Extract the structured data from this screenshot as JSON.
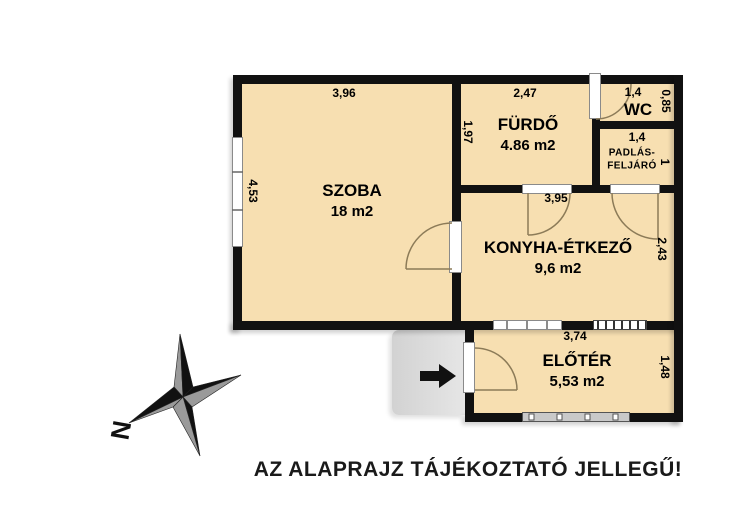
{
  "caption": "AZ ALAPRAJZ TÁJÉKOZTATÓ JELLEGŰ!",
  "compass": {
    "north_label": "N"
  },
  "rooms": {
    "szoba": {
      "name": "SZOBA",
      "area": "18 m2"
    },
    "furdo": {
      "name": "FÜRDŐ",
      "area": "4.86 m2"
    },
    "wc": {
      "name": "WC"
    },
    "padlas": {
      "line1": "PADLÁS-",
      "line2": "FELJÁRÓ"
    },
    "konyha": {
      "name": "KONYHA-ÉTKEZŐ",
      "area": "9,6 m2"
    },
    "eloter": {
      "name": "ELŐTÉR",
      "area": "5,53 m2"
    }
  },
  "dims": {
    "szoba_top": "3,96",
    "szoba_left": "4,53",
    "furdo_top": "2,47",
    "furdo_left": "1,97",
    "wc_top": "1,4",
    "wc_right": "0,85",
    "padlas_top": "1,4",
    "padlas_right": "1",
    "konyha_door": "3,95",
    "konyha_right": "2,43",
    "eloter_top": "3,74",
    "eloter_right": "1,48"
  },
  "colors": {
    "floor": "#f7dfb1",
    "wall": "#111111",
    "porch": "#dcdcdc",
    "arc": "#8c7b58",
    "star_gray": "#9a9a9a"
  }
}
